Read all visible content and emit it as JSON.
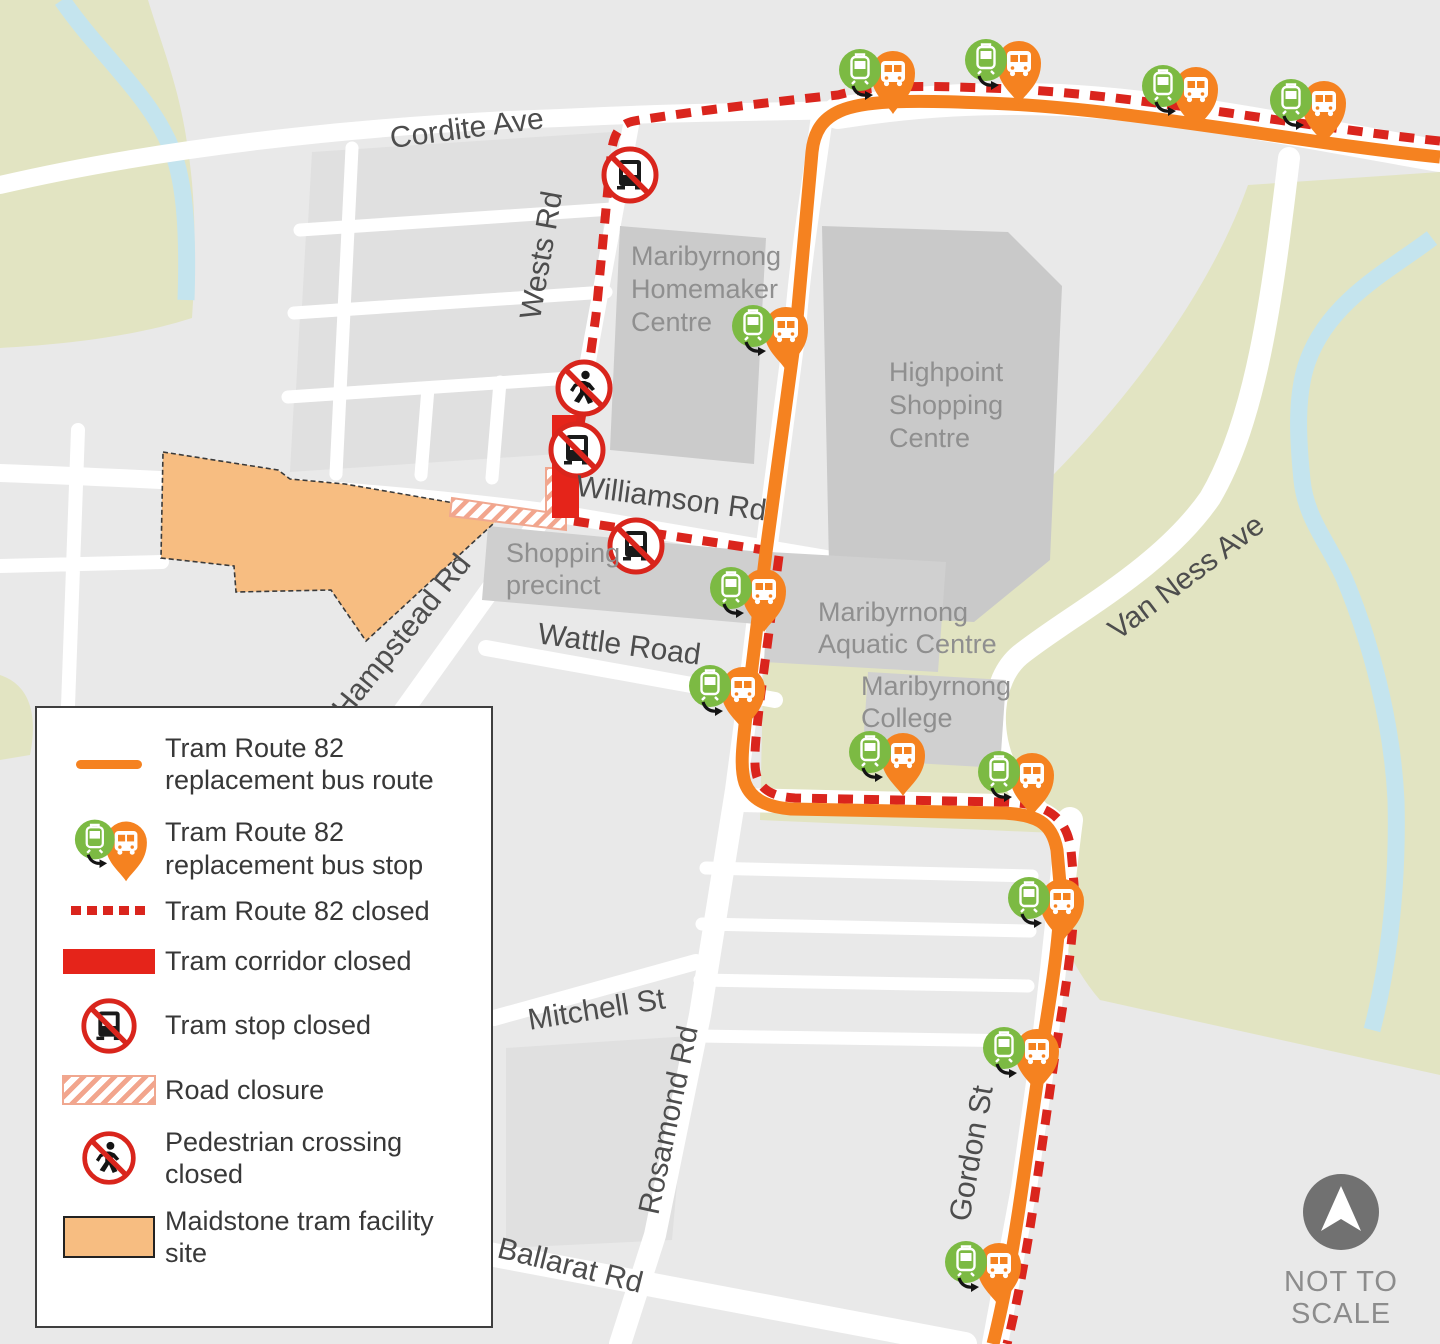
{
  "map": {
    "streets": {
      "cordite": "Cordite Ave",
      "wests": "Wests Rd",
      "williamson": "Williamson Rd",
      "hampstead": "Hampstead Rd",
      "wattle": "Wattle Road",
      "mitchell": "Mitchell St",
      "rosamond": "Rosamond Rd",
      "ballarat": "Ballarat Rd",
      "gordon": "Gordon St",
      "van_ness": "Van Ness Ave"
    },
    "places": {
      "homemaker": {
        "lines": [
          "Maribyrnong",
          "Homemaker",
          "Centre"
        ]
      },
      "highpoint": {
        "lines": [
          "Highpoint",
          "Shopping",
          "Centre"
        ]
      },
      "shopping_precinct": {
        "lines": [
          "Shopping",
          "precinct"
        ]
      },
      "aquatic": {
        "lines": [
          "Maribyrnong",
          "Aquatic Centre"
        ]
      },
      "college": {
        "lines": [
          "Maribyrnong",
          "College"
        ]
      }
    },
    "north": {
      "lines": [
        "NOT TO",
        "SCALE"
      ]
    }
  },
  "legend": {
    "items": [
      {
        "id": "bus-route",
        "label": "Tram Route 82 replacement bus route"
      },
      {
        "id": "bus-stop",
        "label": "Tram Route 82 replacement bus stop"
      },
      {
        "id": "route-closed",
        "label": "Tram Route 82 closed"
      },
      {
        "id": "corridor-closed",
        "label": "Tram corridor closed"
      },
      {
        "id": "stop-closed",
        "label": "Tram stop closed"
      },
      {
        "id": "road-closure",
        "label": "Road closure"
      },
      {
        "id": "ped-crossing-closed",
        "label": "Pedestrian crossing closed"
      },
      {
        "id": "facility-site",
        "label": "Maidstone tram facility site"
      }
    ]
  },
  "colors": {
    "route_orange": "#f58220",
    "closed_red": "#da251d",
    "corridor_red": "#e5241a",
    "stop_green": "#7cba43",
    "facility_orange": "#f7bd81",
    "park_green": "#e2e4c2",
    "river_blue": "#c4e4ee",
    "road_white": "#ffffff",
    "building_gray": "#cbcbcb",
    "background_gray": "#e9e9e9",
    "place_label_gray": "#8f8f8f",
    "street_label_gray": "#4d4d4d",
    "north_gray": "#717171"
  }
}
